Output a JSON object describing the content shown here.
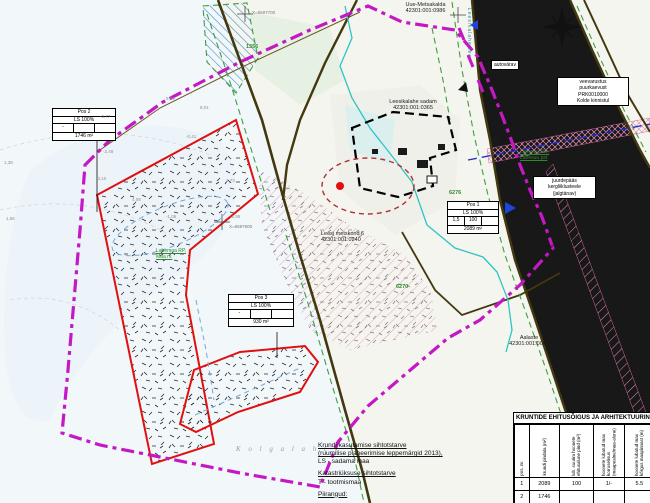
{
  "parcel_labels": {
    "uue_metsakalda": {
      "line1": "Uue-Metsakalda",
      "line2": "42301:001:0986"
    },
    "leesikalahe": {
      "line1": "Leesikalahe sadam",
      "line2": "42301:001:0365"
    },
    "kolde": {
      "line1": "Kolde",
      "line2": "42301:001:0421"
    },
    "leesi_metskond": {
      "line1": "Leesi metskond 6",
      "line2": "42301:001:0240"
    },
    "aalaste": {
      "line1": "Aalaste",
      "line2": "42301:001:0061"
    },
    "juminda": {
      "line1": "III 'Juminda-Leesi tee'",
      "line2": "42301:001:0065"
    }
  },
  "green_labels": {
    "lahemaa": {
      "line1": "Lahemaa RP,",
      "line2": "Maa rv."
    },
    "lahesuu": {
      "line1": "Lahesuu RD,",
      "line2": "Lahesuu pst"
    },
    "parcel_numbers": [
      {
        "t": "1356"
      },
      {
        "t": "6276"
      },
      {
        "t": "6270"
      }
    ]
  },
  "note_boxes": {
    "autovarav": "autovärav",
    "veevarustus": {
      "l1": "veevarustus",
      "l2": "puurkaevust",
      "l3": "PRK0010000",
      "l4": "Kolde kinnistul"
    },
    "juurdepaas": {
      "l1": "juurdepääs",
      "l2": "kergliiklusteele",
      "l3": "(jalgtänav)"
    }
  },
  "pos_boxes": [
    {
      "title": "Pos 2",
      "sub": "LS 100%",
      "cells": [
        "-",
        "",
        ""
      ],
      "area": "1746 m²"
    },
    {
      "title": "Pos 3",
      "sub": "LS 100%",
      "cells": [
        "-",
        "",
        ""
      ],
      "area": "930 m²"
    },
    {
      "title": "Pos 1",
      "sub": "LS 100%",
      "cells": [
        "1,5",
        "100",
        ""
      ],
      "area": "2089 m²"
    }
  ],
  "legend": {
    "h1": "Krundi kasutamise sihtotstarve",
    "h2": "(ruumilise planeerimise leppemärgid 2013),",
    "v1": "LS - sadama maa",
    "h3": "Katastriüksuse sihtotstarve",
    "v2": "T - tootmismaa",
    "h4": "Piirangud:"
  },
  "etable": {
    "title": "KRUNTIDE EHITUSÕIGUS JA ARHITEKTUURINÕUDED",
    "headers": [
      "pos. nr.",
      "krundi pindala (m²)",
      "lub. suurim hoonete ehitusalune pind (m²)",
      "hoonete lubatud max korruselisus (maapealne/maa-alune)",
      "hoonete lubatud max kõrgus maapinnast (m)"
    ],
    "rows": [
      [
        "1",
        "2089",
        "100",
        "1/-",
        "5.5"
      ],
      [
        "2",
        "1746",
        "",
        "",
        ""
      ]
    ]
  },
  "sea_label": "K o l g a   l a h t",
  "street_vertical": "Leesikalahe tee",
  "coords": [
    {
      "t": "X=6597700"
    },
    {
      "t": "X=6597600"
    }
  ],
  "elevations": [
    {
      "t": "1,38"
    },
    {
      "t": "1,55"
    },
    {
      "t": "-2,77"
    },
    {
      "t": "-2,48"
    },
    {
      "t": "-3,10"
    },
    {
      "t": "5,89"
    },
    {
      "t": "8,01"
    },
    {
      "t": "-0,41"
    },
    {
      "t": "2,73"
    },
    {
      "t": "-1,05"
    },
    {
      "t": "-2,95"
    },
    {
      "t": "4,08"
    }
  ],
  "compass_n": "N",
  "colors": {
    "plan_boundary": "#c318c3",
    "plot_line": "#e01010",
    "road": "#43390f",
    "green_dash": "#3f9e3f",
    "water_cyan": "#2ec4c4",
    "utility_navy": "#2233cc",
    "monument_zone": "#b03030"
  }
}
